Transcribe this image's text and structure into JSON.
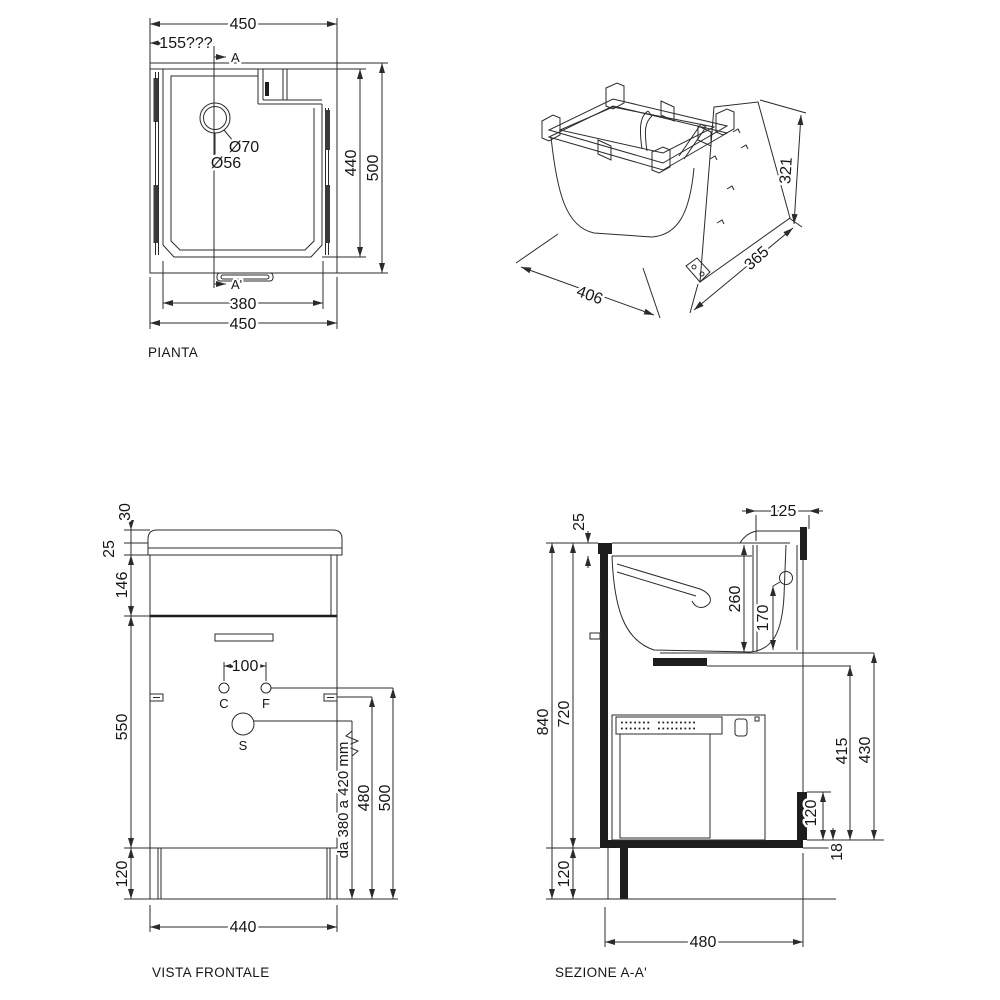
{
  "drawing": {
    "background": "#ffffff",
    "line_color": "#2b2b2b",
    "views": {
      "plan": {
        "caption": "PIANTA",
        "section_marker_top": "A",
        "section_marker_bottom": "A'",
        "dims": {
          "overall_width_top": "450",
          "drain_offset": "155???",
          "drain_outer_diameter": "Ø70",
          "drain_inner_diameter": "Ø56",
          "basin_depth": "440",
          "overall_depth": "500",
          "basin_width": "380",
          "overall_width_bottom": "450"
        }
      },
      "isometric": {
        "dims": {
          "height": "321",
          "depth": "365",
          "width": "406"
        }
      },
      "front": {
        "caption": "VISTA FRONTALE",
        "labels": {
          "cold_tap": "C",
          "hot_tap": "F",
          "drain": "S"
        },
        "dims": {
          "top_thickness": "30",
          "rim_thickness": "25",
          "basin_front_height": "146",
          "door_height": "550",
          "plinth_height": "120",
          "tap_spacing": "100",
          "drain_height_range": "da 380 a 420 mm",
          "handle_height": "480",
          "tap_height": "500",
          "cabinet_width": "440"
        }
      },
      "section": {
        "caption": "SEZIONE A-A'",
        "dims": {
          "rim_depth": "125",
          "rim_thickness": "25",
          "basin_depth": "260",
          "overflow_height": "170",
          "overall_height": "840",
          "cabinet_height": "720",
          "plinth_height": "120",
          "niche_height_inner": "415",
          "niche_height": "430",
          "step_height": "120",
          "bottom_thickness": "18",
          "overall_depth": "480"
        }
      }
    }
  }
}
